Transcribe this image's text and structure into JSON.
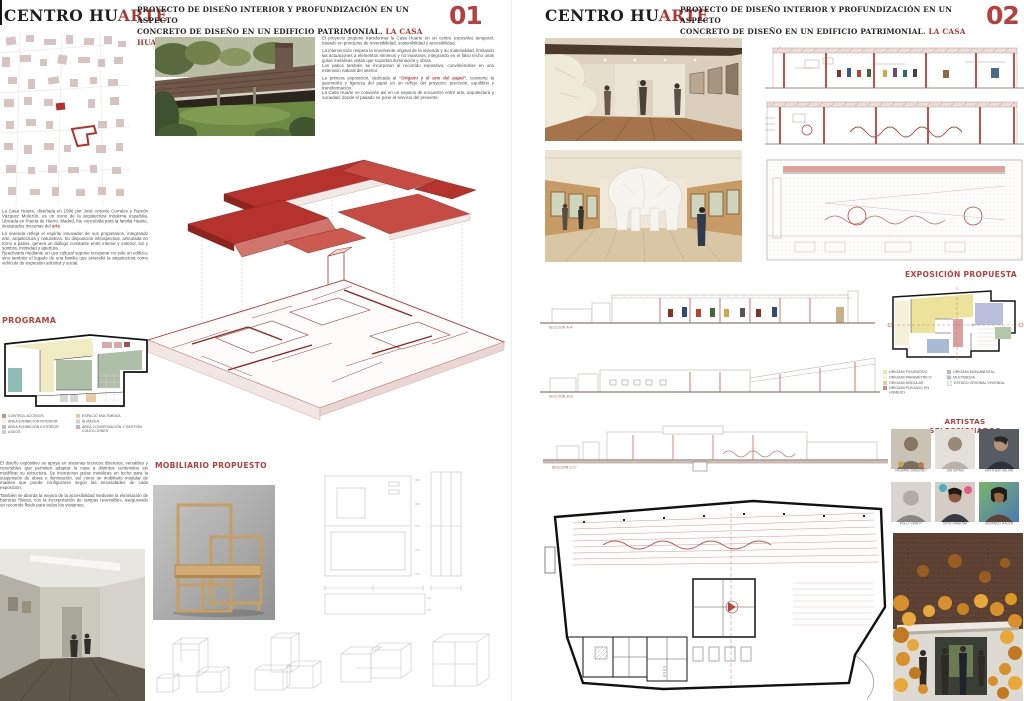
{
  "accent": "#b5413c",
  "header": {
    "title_black": "CENTRO HU",
    "title_red": "ARTE",
    "subtitle_line1": "PROYECTO DE DISEÑO INTERIOR Y PROFUNDIZACIÓN EN UN ASPECTO",
    "subtitle_line2": "CONCRETO DE DISEÑO EN UN EDIFICIO PATRIMONIAL. ",
    "subtitle_red": "LA CASA HUARTE"
  },
  "panel1": {
    "number": "01",
    "intro": {
      "p1": "El proyecto propone transformar la Casa Huarte en un centro expositivo temporal, basado en principios de reversibilidad, sostenibilidad y accesibilidad.",
      "p2": "La intervención respeta la envolvente original de la vivienda y su materialidad, limitando las actuaciones a elementos mínimos y no invasivos, integrando en el falso techo unas guías metálicas vistas que soportan iluminación y obras.",
      "p3": "Los patios también se incorporan al recorrido expositivo, convirtiéndose en una extensión natural del interior.",
      "p4_pre": "La primera exposición, dedicada al ",
      "p4_red": "“Origami y el arte del papel”",
      "p4_post": ", convierte la geometría y ligereza del papel en un reflejo del proyecto: precisión, equilibrio y transformación.",
      "p5": "La Casa Huarte se convierte así en un espacio de encuentro entre arte, arquitectura y sociedad, donde el pasado se pone al servicio del presente."
    },
    "history": {
      "p1_pre": "La Casa Huarte, diseñada en 1966 por José Antonio Corrales y Ramón Vázquez Molezún, es un icono de la arquitectura moderna española. Ubicada en Puerta de Hierro, Madrid, fue concebida para la familia Huarte, destacados mecenas del ",
      "p1_red": "arte",
      "p1_post": ".",
      "p2": "La vivienda refleja el espíritu innovador de sus propietarios, integrando arte, arquitectura y naturaleza. Su disposición introspectiva, articulada en torno a patios, genera un diálogo constante entre interior y exterior, luz y sombra, intimidad y apertura.",
      "p3": "Reactivarla mediante un uso cultural supone recuperar no solo un edificio, sino también el legado de una familia que entendió la arquitectura como vehículo de expresión artística y social."
    },
    "programa": {
      "heading": "PROGRAMA",
      "legend_left": [
        {
          "label": "CONTROL ACCESOS",
          "color": "#c98f8c"
        },
        {
          "label": "ÁREA EXHIBICIÓN INTERIOR",
          "color": "#f3eecb"
        },
        {
          "label": "ÁREA EXHIBICIÓN EXTERIOR",
          "color": "#b8c3b1"
        },
        {
          "label": "ASEOS",
          "color": "#cbcbcb"
        }
      ],
      "legend_right": [
        {
          "label": "ESPACIO MULTIMEDIA",
          "color": "#ecca9c"
        },
        {
          "label": "ALMACÉN",
          "color": "#bfd6da"
        },
        {
          "label": "ÁREA CONSERVACIÓN Y GESTIÓN COLECCIONES",
          "color": "#dcaaa8"
        }
      ]
    },
    "expo_design": {
      "p1": "El diseño expositivo se apoya en sistemas técnicos discretos, versátiles y reversibles que permiten adaptar la casa a distintos contenidos sin modificar su estructura. Se incorporan guías metálicas en techo para la suspensión de obras e iluminación, así como un mobiliario modular de madera que puede configurarse según las necesidades de cada exposición.",
      "p2": "También se aborda la mejora de la accesibilidad mediante la eliminación de barreras físicas, con la incorporación de rampas reversibles, asegurando un recorrido fluido para todos los visitantes."
    },
    "mobiliario_heading": "MOBILIARIO PROPUESTO"
  },
  "panel2": {
    "number": "02",
    "secciones": [
      "SECCIÓN A-A'",
      "SECCIÓN B-B'",
      "SECCIÓN C-C'"
    ],
    "exposicion": {
      "heading": "EXPOSICIÓN PROPUESTA",
      "legend_left": [
        {
          "label": "ORIGAMI FIGURATIVO",
          "color": "#efe5a6"
        },
        {
          "label": "ORIGAMI PARAMÉTRICO",
          "color": "#f6f0d9"
        },
        {
          "label": "ORIGAMI MODULAR",
          "color": "#eac98f"
        },
        {
          "label": "ORIGAMI PLEGADO EN HÚMEDO",
          "color": "#c28f8f"
        }
      ],
      "legend_right": [
        {
          "label": "ORIGAMI MONUMENTAL",
          "color": "#abc6a3"
        },
        {
          "label": "MULTIMEDIA",
          "color": "#a9c2d9"
        },
        {
          "label": "ESTADO ORIGINAL VIVIENDA",
          "color": "#f4f3ee"
        }
      ]
    },
    "artistas": {
      "heading": "ARTISTAS SELECCIONADOS",
      "names": [
        "RICHARD SWEENEY",
        "JUN MITANI",
        "MATTHEW SHLIAN",
        "POLLY VERITY",
        "SIPHO MABONA",
        "GERARDO HACER"
      ]
    }
  }
}
